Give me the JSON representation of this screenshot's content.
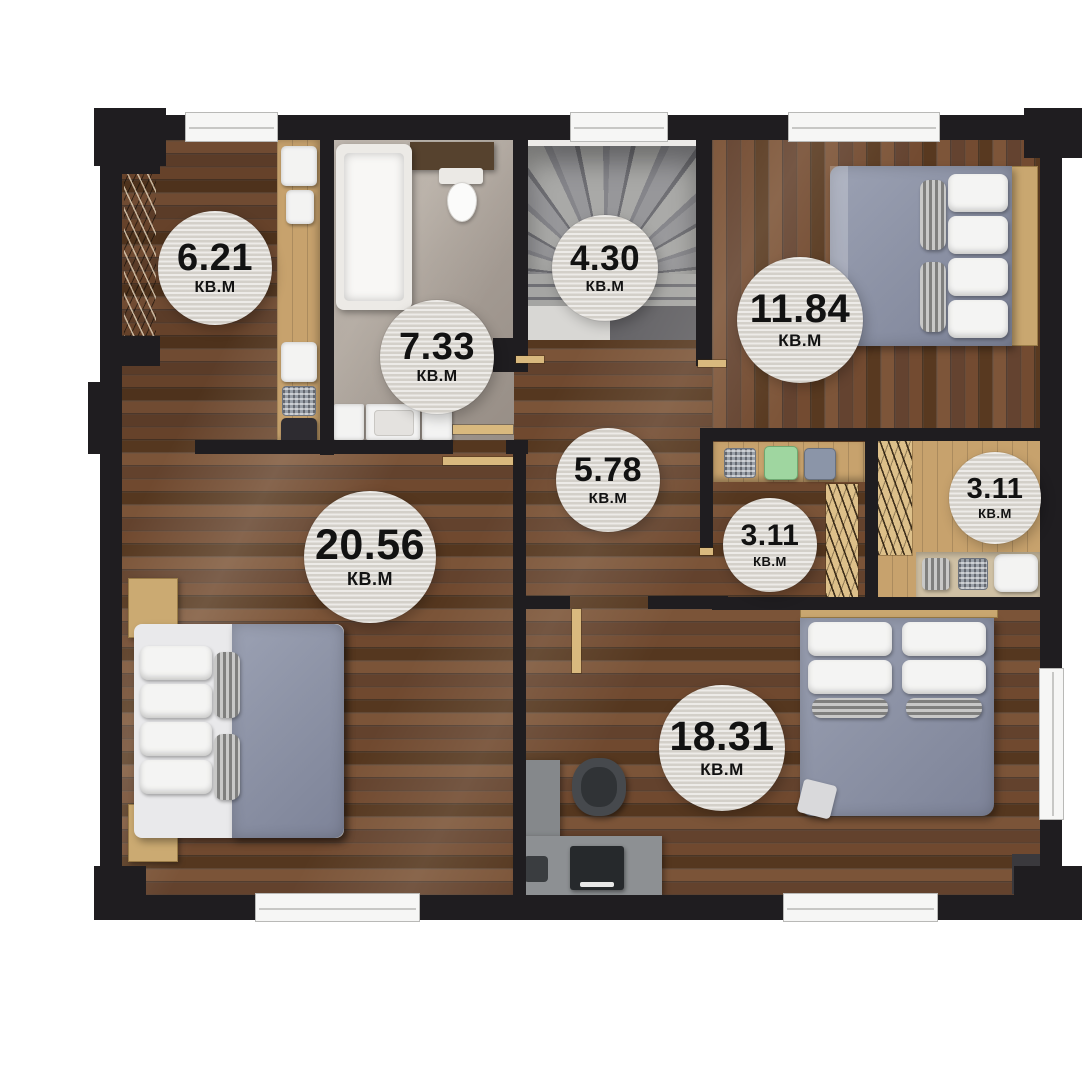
{
  "unit": "КВ.М",
  "rooms": [
    {
      "name": "dressing-room",
      "area": "6.21"
    },
    {
      "name": "bathroom",
      "area": "7.33"
    },
    {
      "name": "staircase",
      "area": "4.30"
    },
    {
      "name": "bedroom-top-right",
      "area": "11.84"
    },
    {
      "name": "hallway",
      "area": "5.78"
    },
    {
      "name": "bedroom-left",
      "area": "20.56"
    },
    {
      "name": "walk-in-closet-left",
      "area": "3.11"
    },
    {
      "name": "walk-in-closet-right",
      "area": "3.11"
    },
    {
      "name": "bedroom-bottom-right",
      "area": "18.31"
    }
  ],
  "colors": {
    "wall": "#1f1d20",
    "wood_floor": "#6a4530",
    "light_wood": "#c9a770",
    "tile": "#a79e96",
    "stairs": "#8f8f8d",
    "bedding": "#8d93a6",
    "label_background": "#dbd7d0",
    "label_text": "#121212"
  }
}
